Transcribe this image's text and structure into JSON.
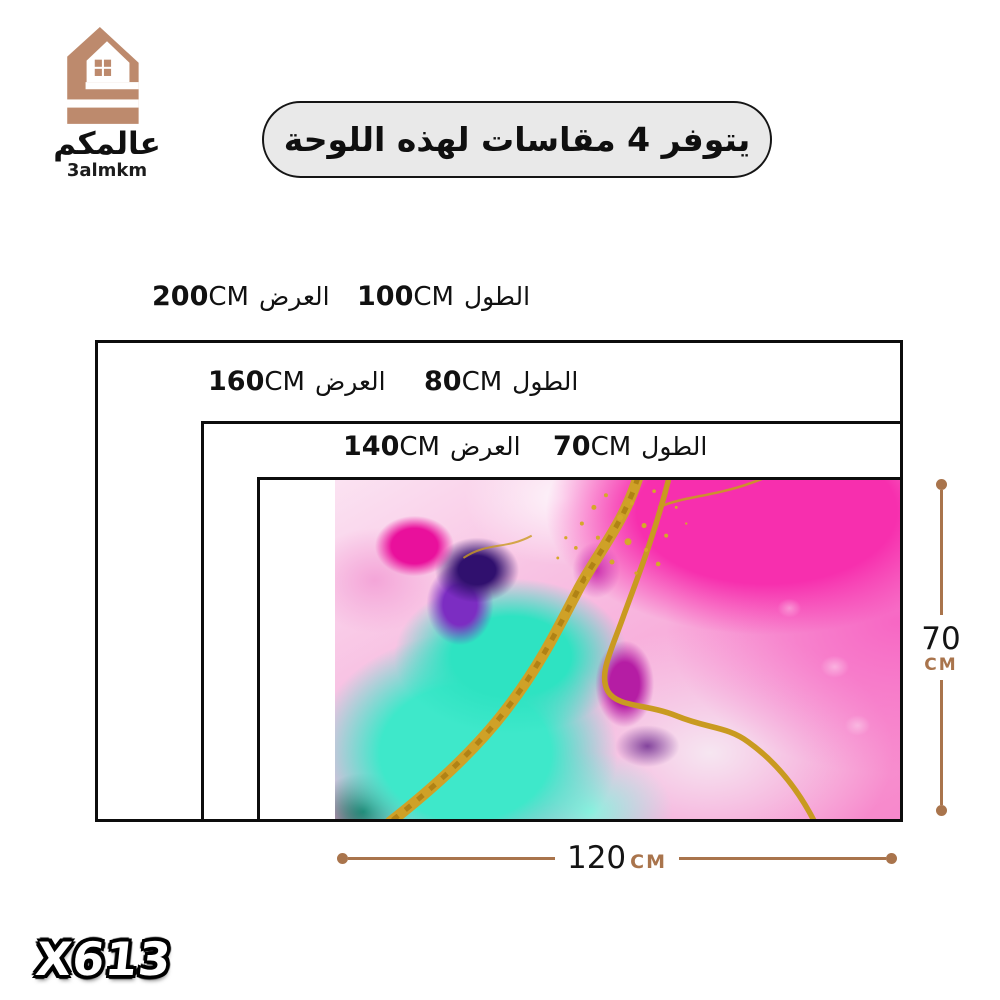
{
  "logo": {
    "brand_ar": "عالمكم",
    "brand_en": "3almkm"
  },
  "banner": {
    "text": "يتوفر 4 مقاسات لهذه اللوحة"
  },
  "size_rows": [
    {
      "width_value": "200",
      "width_unit": "CM",
      "width_word": "العرض",
      "length_value": "100",
      "length_unit": "CM",
      "length_word": "الطول"
    },
    {
      "width_value": "160",
      "width_unit": "CM",
      "width_word": "العرض",
      "length_value": "80",
      "length_unit": "CM",
      "length_word": "الطول"
    },
    {
      "width_value": "140",
      "width_unit": "CM",
      "width_word": "العرض",
      "length_value": "70",
      "length_unit": "CM",
      "length_word": "الطول"
    }
  ],
  "artwork_size": {
    "width_value": "120",
    "width_unit": "CM",
    "height_value": "70",
    "height_unit": "CM"
  },
  "product_code": "X613",
  "colors": {
    "brand_brown": "#bd8a6d",
    "marker_brown": "#a9744c",
    "banner_bg": "#e9e9e9",
    "outline_black": "#0d0d0d"
  },
  "artwork": {
    "description": "Abstract alcohol-ink wall art: pink and magenta washes, teal flow, purple blobs, gold glitter veins"
  }
}
